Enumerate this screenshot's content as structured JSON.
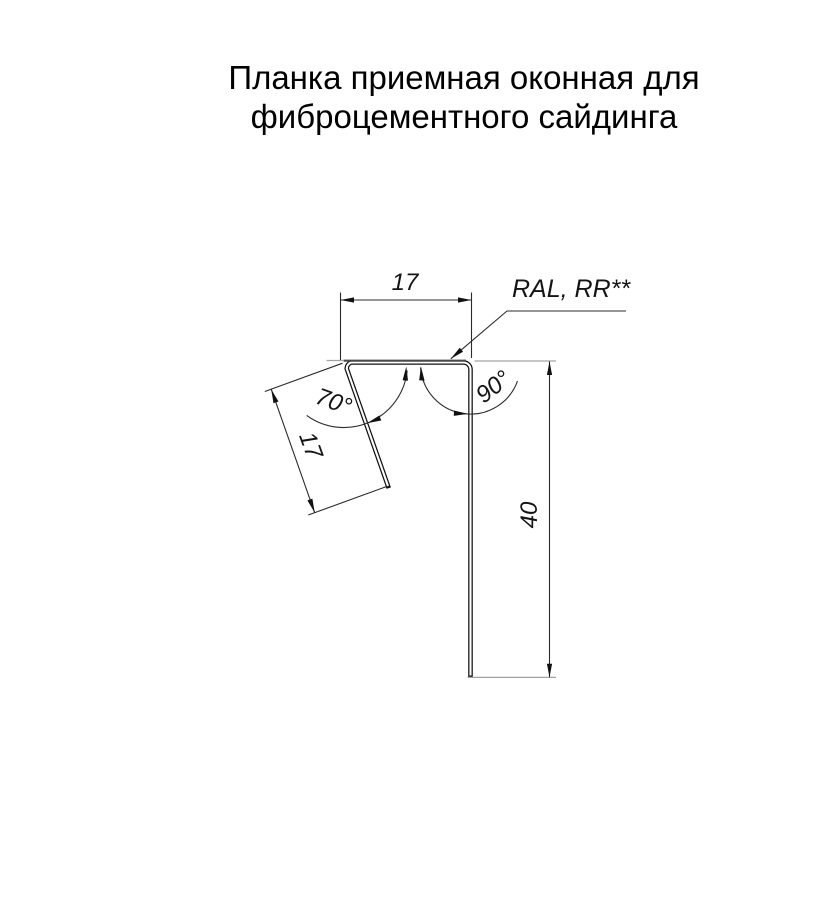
{
  "title": {
    "line1": "Планка приемная оконная для",
    "line2": "фиброцементного сайдинга"
  },
  "dimensions": {
    "top_width": "17",
    "flange_length": "17",
    "height": "40",
    "flange_angle": "70°",
    "right_angle": "90°"
  },
  "labels": {
    "coating": "RAL, RR**"
  },
  "colors": {
    "background": "#ffffff",
    "profile_line": "#111111",
    "metal_top_edge": "#4a4a4a",
    "dimension_line": "#2b2b2b",
    "reference_line": "#a3a3a3",
    "text": "#141414"
  }
}
